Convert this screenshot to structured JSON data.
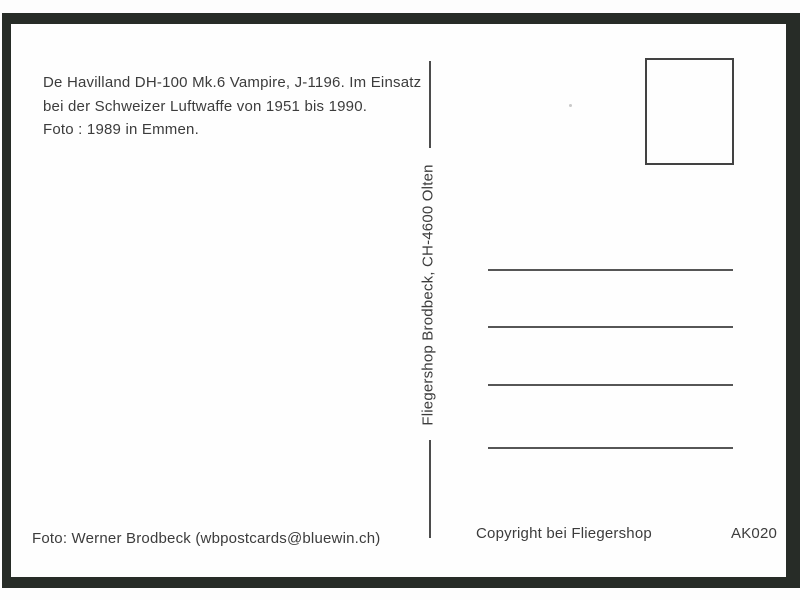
{
  "card": {
    "description_lines": [
      "De Havilland DH-100 Mk.6 Vampire, J-1196. Im Einsatz",
      "bei der Schweizer Luftwaffe von 1951 bis 1990.",
      "Foto : 1989 in Emmen."
    ],
    "publisher_vertical_text": "Fliegershop Brodbeck, CH-4600 Olten",
    "photo_credit": "Foto: Werner Brodbeck (wbpostcards@bluewin.ch)",
    "copyright_text": "Copyright bei Fliegershop",
    "catalog_number": "AK020",
    "address_line_count": 4,
    "colors": {
      "frame": "#272c27",
      "card": "#fefefe",
      "ink": "#3c3c3c",
      "rule": "#565656",
      "divider": "#4c4c4c",
      "stamp_border": "#424242"
    }
  }
}
